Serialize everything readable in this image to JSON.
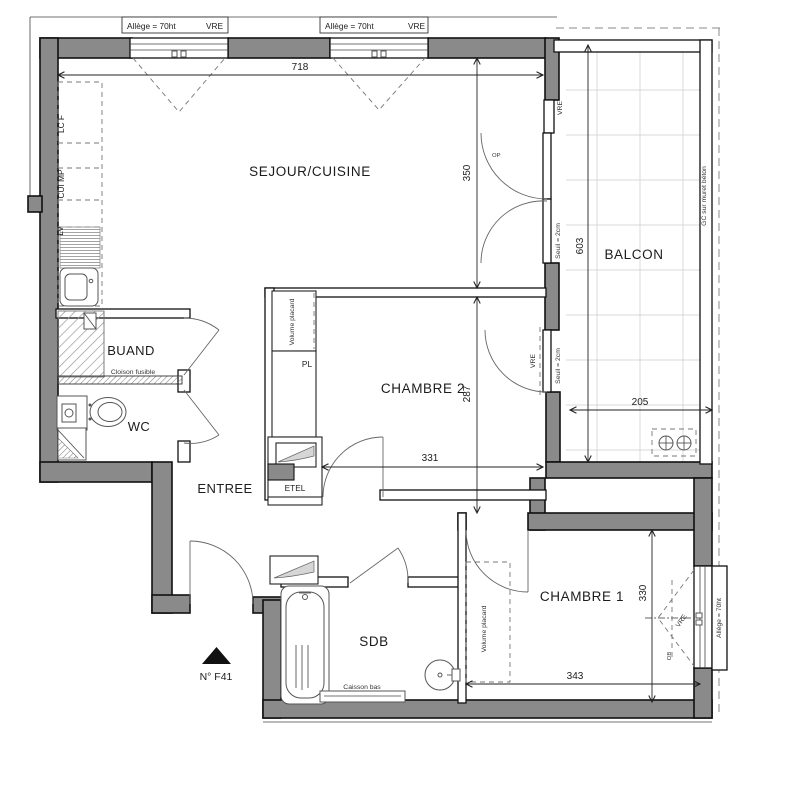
{
  "plan": {
    "unit_label": "N° F41",
    "rooms": {
      "sejour": "SEJOUR/CUISINE",
      "balcon": "BALCON",
      "chambre2": "CHAMBRE 2",
      "chambre1": "CHAMBRE 1",
      "sdb": "SDB",
      "buanderie": "BUAND",
      "wc": "WC",
      "entree": "ENTREE"
    },
    "annotations": {
      "allege": "Allège = 70ht",
      "vre": "VRE",
      "seuil": "Seuil = 2cm",
      "gc_muret": "GC sur muret béton",
      "volume_placard": "Volume placard",
      "pl": "PL",
      "etel": "ETEL",
      "cloison_fusible": "Cloison fusible",
      "caisson_bas": "Caisson bas",
      "lc_f": "LC F",
      "cui_mp": "CUI MP",
      "lv": "LV",
      "op": "OP",
      "ob": "OB"
    },
    "dimensions": {
      "sejour_width": "718",
      "sejour_height": "350",
      "balcon_height": "603",
      "balcon_width": "205",
      "chambre2_height": "287",
      "chambre2_width": "331",
      "chambre1_height": "330",
      "chambre1_width": "343"
    },
    "colors": {
      "wall_fill": "#8a8a8a",
      "line": "#1c1c1c",
      "grid": "#cccccc",
      "paper": "#ffffff"
    }
  }
}
